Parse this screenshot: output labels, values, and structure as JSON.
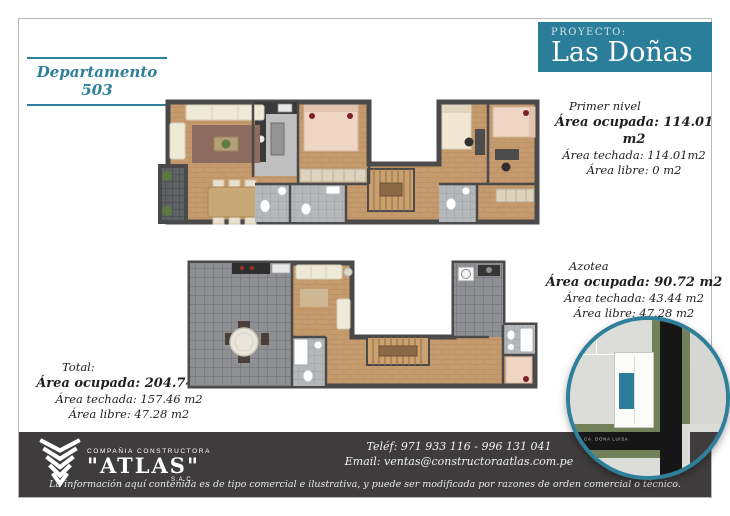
{
  "colors": {
    "accent_teal": "#2b7e99",
    "teal_text": "#2e7f9b",
    "footer_bg": "#3f3c3d",
    "wall": "#4a4a4a",
    "wood_floor": "#c59b6d",
    "terrace_tile": "#8f9093"
  },
  "header": {
    "apartment_label": "Departamento 503",
    "project_label": "PROYECTO:",
    "project_name": "Las Doñas"
  },
  "area_blocks": {
    "first_level": {
      "title": "Primer nivel",
      "occupied": "Área ocupada: 114.01 m2",
      "roofed": "Área techada: 114.01m2",
      "free": "Área libre: 0 m2"
    },
    "rooftop": {
      "title": "Azotea",
      "occupied": "Área ocupada: 90.72 m2",
      "roofed": "Área techada: 43.44 m2",
      "free": "Área libre: 47.28 m2"
    },
    "total": {
      "title": "Total:",
      "occupied": "Área ocupada: 204.74 m2",
      "roofed": "Área techada: 157.46 m2",
      "free": "Área libre: 47.28 m2"
    }
  },
  "map": {
    "street_vertical": "JR. DOÑA CATALINA",
    "street_horizontal": "CA. DOÑA LUISA"
  },
  "footer": {
    "company_line": "COMPAÑIA CONSTRUCTORA",
    "company_name": "\"ATLAS\"",
    "company_suffix": "S.A.C.",
    "phone_label": "Teléf:",
    "phone_value": "971 933 116 - 996 131 041",
    "email_label": "Email:",
    "email_value": "ventas@constructoraatlas.com.pe",
    "disclaimer": "La información aquí contenida es de tipo comercial e ilustrativa, y puede ser modificada por razones de orden comercial o técnico."
  }
}
